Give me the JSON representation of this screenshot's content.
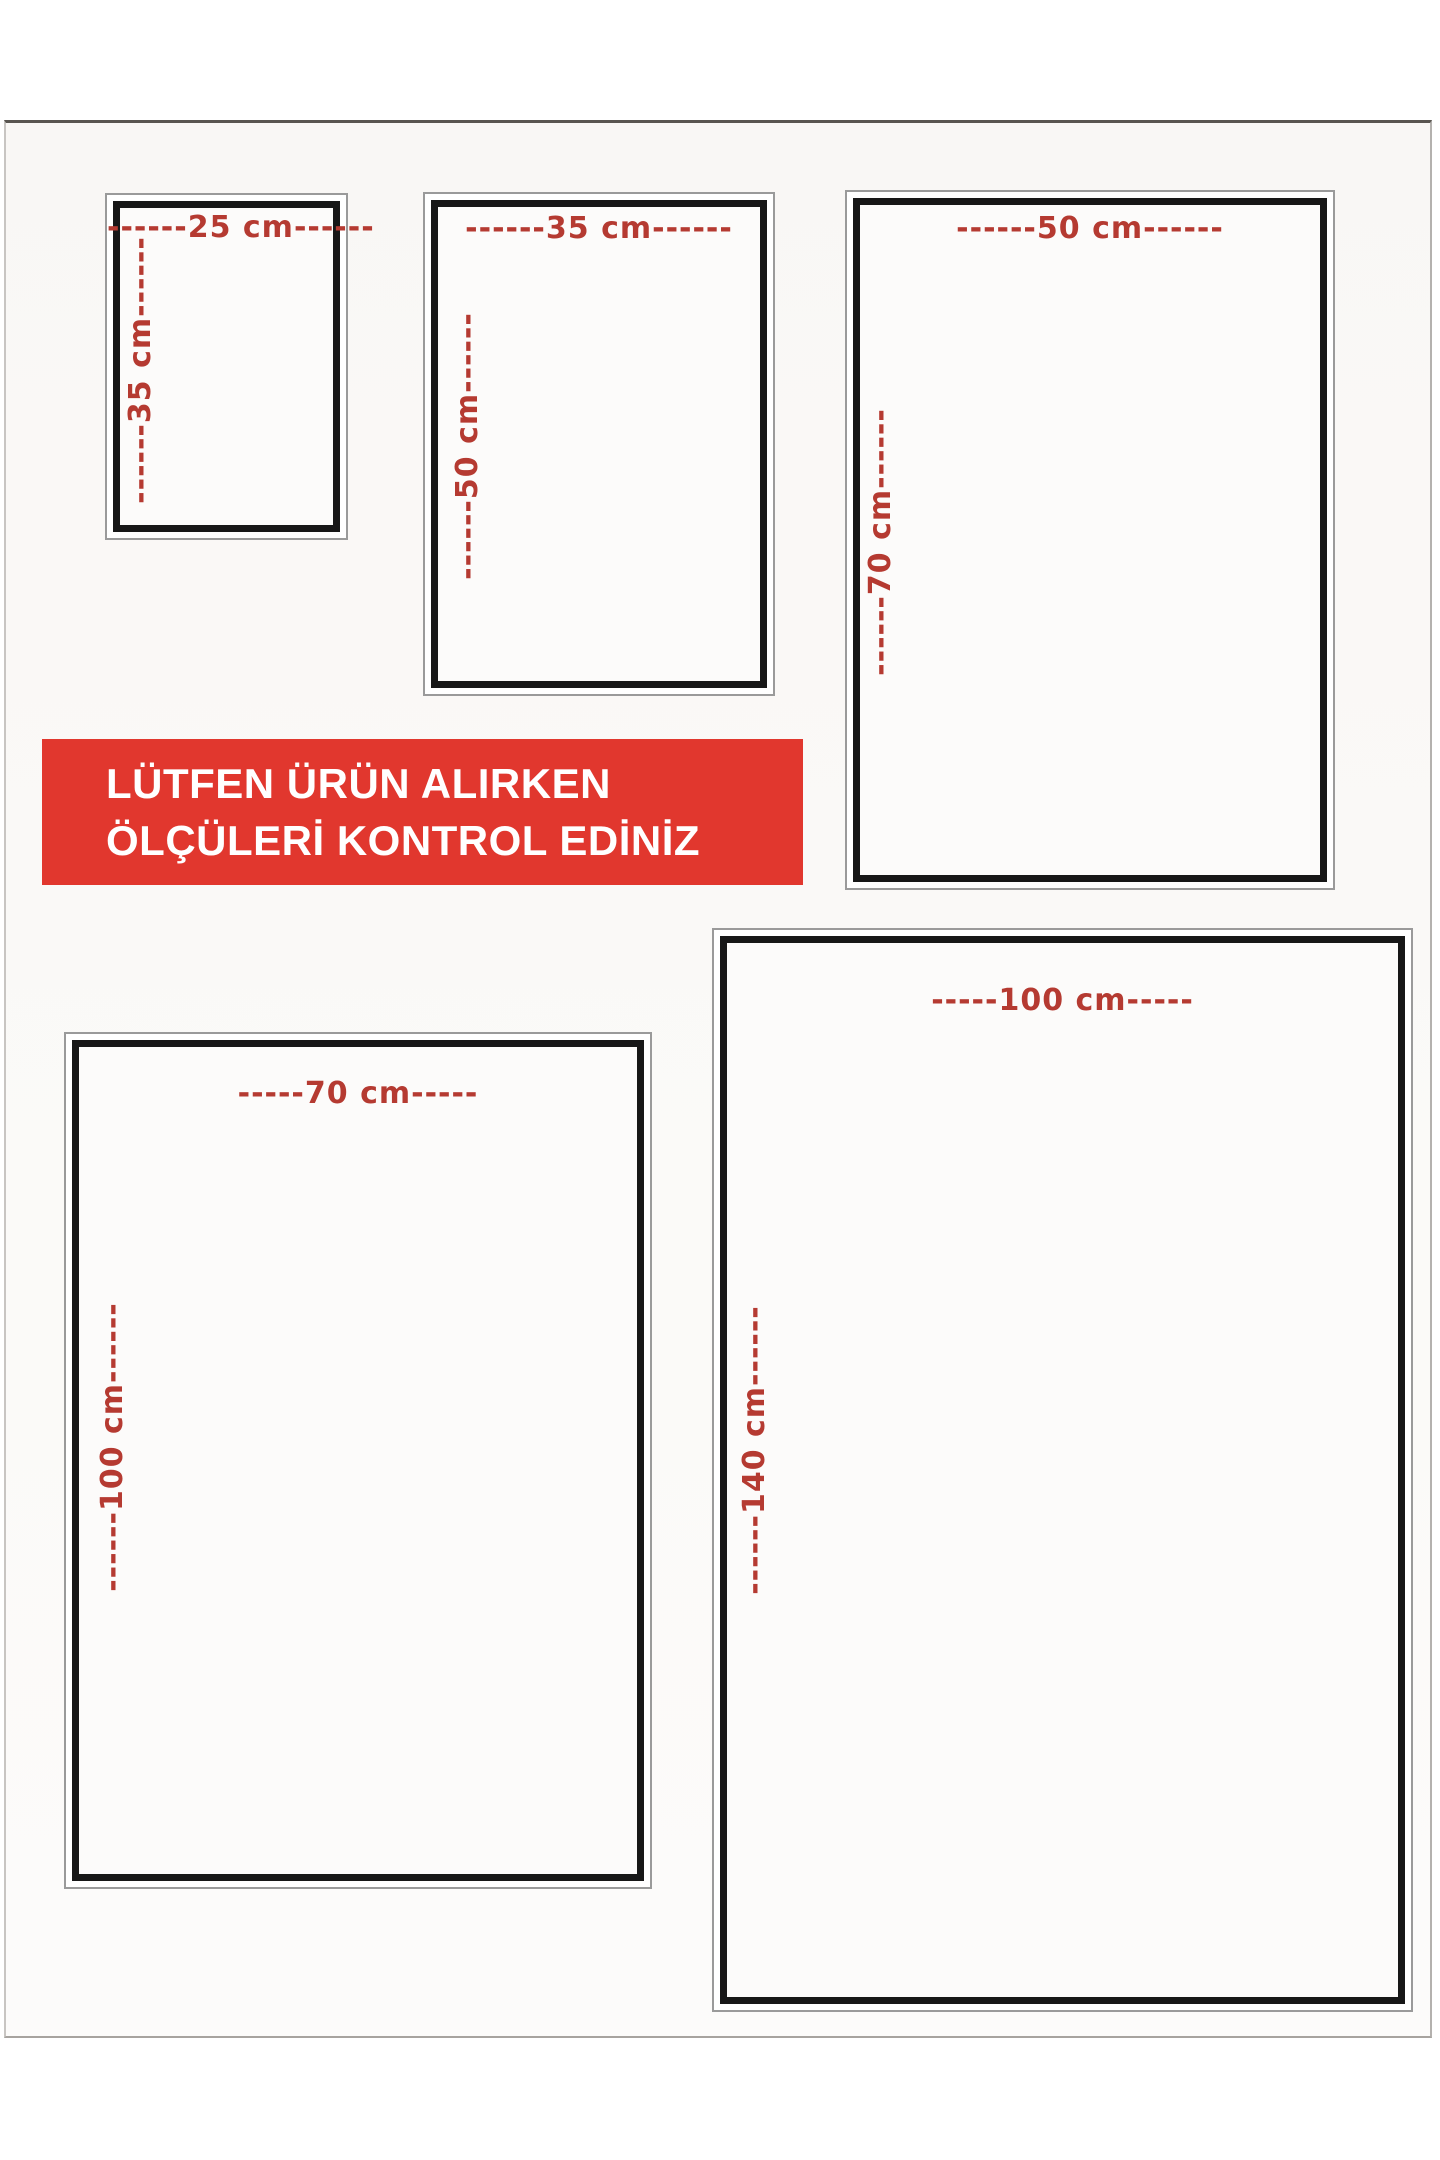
{
  "banner": {
    "line1": "LÜTFEN ÜRÜN ALIRKEN",
    "line2": "ÖLÇÜLERİ KONTROL EDİNİZ",
    "background_color": "#e1372e",
    "text_color": "#ffffff"
  },
  "colors": {
    "dimension_text": "#b53a31",
    "box_outer_border": "#9a9a9a",
    "box_inner_border": "#171717",
    "page_background": "#f9f7f5"
  },
  "size_boxes": [
    {
      "name": "25x35",
      "width_cm": 25,
      "height_cm": 35,
      "width_label": "------25 cm------",
      "height_label": "------35 cm------"
    },
    {
      "name": "35x50",
      "width_cm": 35,
      "height_cm": 50,
      "width_label": "------35 cm------",
      "height_label": "------50 cm------"
    },
    {
      "name": "50x70",
      "width_cm": 50,
      "height_cm": 70,
      "width_label": "------50 cm------",
      "height_label": "------70 cm------"
    },
    {
      "name": "70x100",
      "width_cm": 70,
      "height_cm": 100,
      "width_label": "-----70 cm-----",
      "height_label": "------100 cm------"
    },
    {
      "name": "100x140",
      "width_cm": 100,
      "height_cm": 140,
      "width_label": "-----100 cm-----",
      "height_label": "------140 cm------"
    }
  ]
}
